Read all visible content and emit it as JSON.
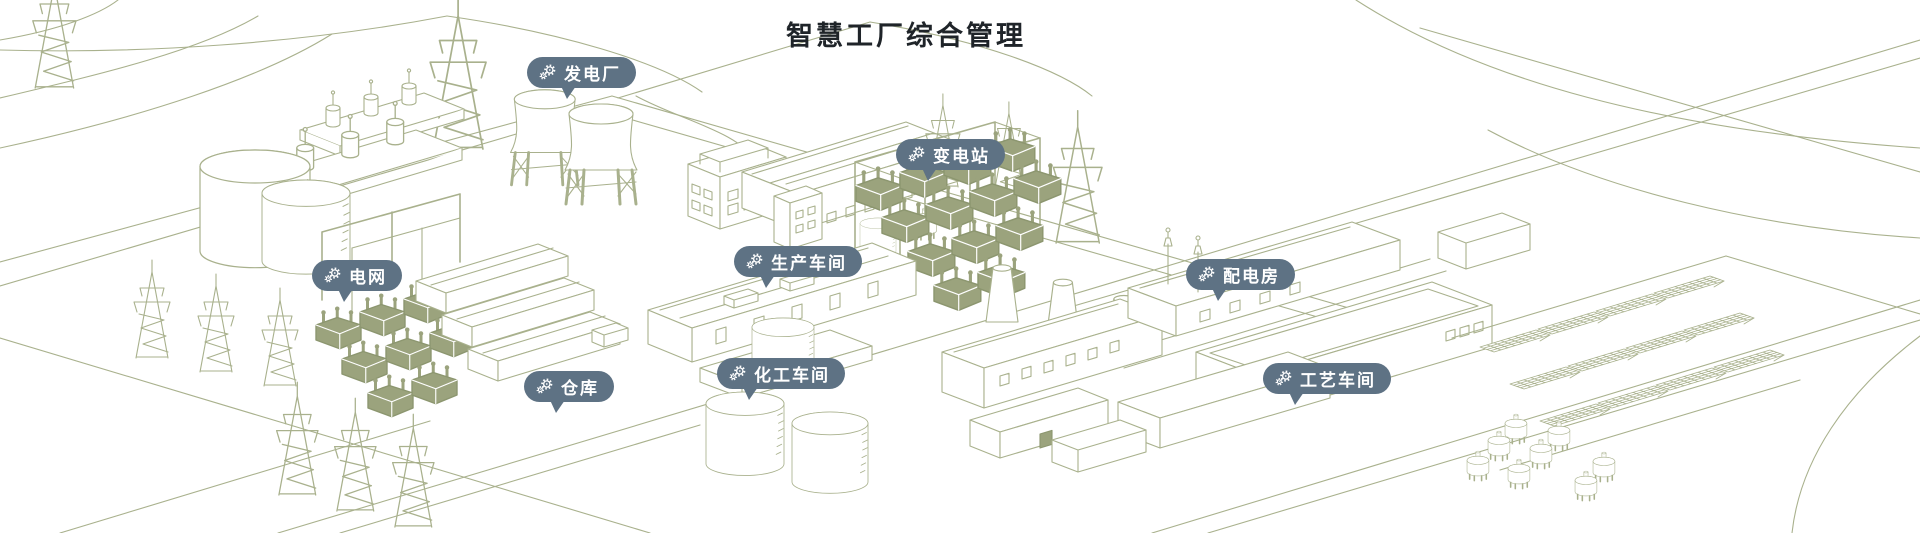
{
  "title": "智慧工厂综合管理",
  "colors": {
    "badge_bg": "#5e7284",
    "badge_text": "#ffffff",
    "title_text": "#1f2429",
    "line_color": "#a9b18d",
    "solid_fill": "#9ba37d"
  },
  "badges": [
    {
      "id": "power-plant",
      "label": "发电厂",
      "icon": "gears"
    },
    {
      "id": "substation",
      "label": "变电站",
      "icon": "gears"
    },
    {
      "id": "power-grid",
      "label": "电网",
      "icon": "gears"
    },
    {
      "id": "production-workshop",
      "label": "生产车间",
      "icon": "gears"
    },
    {
      "id": "distribution-room",
      "label": "配电房",
      "icon": "gears"
    },
    {
      "id": "warehouse",
      "label": "仓库",
      "icon": "gears"
    },
    {
      "id": "chemical-workshop",
      "label": "化工车间",
      "icon": "gears"
    },
    {
      "id": "process-workshop",
      "label": "工艺车间",
      "icon": "gears"
    }
  ]
}
